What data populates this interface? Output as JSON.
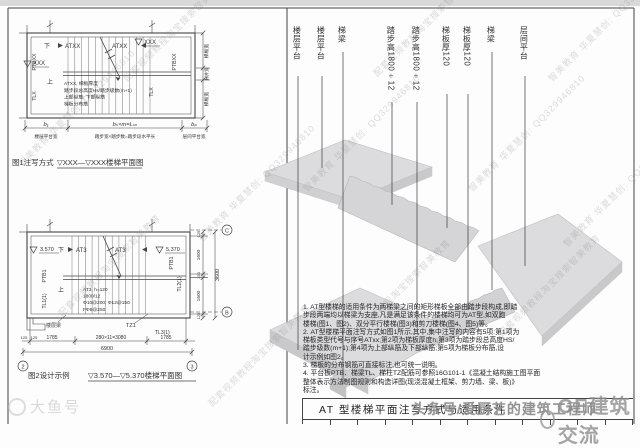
{
  "diagram1": {
    "caption_label": "图1注写方式",
    "caption_title": "▽XXX—▽XXX楼梯平面图",
    "labels": {
      "down": "下",
      "up": "上",
      "flight_left": "ATXX",
      "flight_right": "ATXX",
      "elev_left": "XXX",
      "elev_top_right": "XXX",
      "ptb_left": "PTBXX",
      "ptb_right": "PTBXX",
      "tl_left": "TLX",
      "tl_right": "TLX"
    },
    "note_block": {
      "l1": "ATXX, 梯板厚度",
      "l2": "踏步段总高度Hs/踏步级数(m+1)",
      "l3": "上部纵筋; 下部纵筋",
      "l4": "梯板分布筋"
    },
    "dims_bottom": {
      "seg1": "b₁",
      "seg2": "bₛ×m=Lₛₙ",
      "seg3": "bₚ",
      "sub1": "楼层平台宽",
      "sub2": "踏步宽×踏步数=踏步段水平长",
      "sub3": "层间平台宽"
    },
    "dims_right": {
      "r1": "梯板宽",
      "r2": "梯井宽",
      "r3": "梯板宽"
    }
  },
  "diagram2": {
    "caption_label": "图2设计示例",
    "caption_title": "▽3.570—▽5.370楼梯平面图",
    "labels": {
      "down": "下",
      "up": "上",
      "flight_left": "AT3",
      "flight_right": "AT3",
      "elev_left": "3.570",
      "elev_right": "5.370",
      "ptb_left": "PTB1",
      "ptb_right": "PTB1",
      "tl_left": "TL1(1)",
      "tl_right": "TL2(1)",
      "floor_beam": "楼层梁",
      "tz": "TZ1",
      "tl3": "TL3(1)"
    },
    "note_block": {
      "l1": "AT3, h=120",
      "l2": "1800/12",
      "l3": "Φ10@200; Φ12@150",
      "l4": "FΦ8@250"
    },
    "dims_bottom": {
      "off_l1": "125",
      "off_l2": "125",
      "seg1": "1785",
      "seg2": "280×11=3080",
      "seg3": "1785",
      "total": "6900",
      "axis_left": "2",
      "axis_right": "3"
    },
    "dims_right": {
      "v1": "125",
      "v2": "1600",
      "v3": "150",
      "v4": "1600",
      "v5": "125",
      "total": "3600",
      "axis_top": "C",
      "axis_bottom": "B"
    }
  },
  "iso": {
    "labels": [
      "楼层平台",
      "楼层平台",
      "梯梁",
      "踏步高1800÷12",
      "踏步高1800÷12",
      "梯板厚120",
      "梯板厚120",
      "梯梁",
      "层间平台"
    ]
  },
  "notes": {
    "text": "1. AT型楼梯的适用条件为两梯梁之间的矩形梯板全部由踏步段构成,即踏\n步段两端均以梯梁为支座,凡是满足该条件的楼梯均可为AT型,如双跑\n楼梯(图1、图2)、双分平行楼梯(图3)和剪刀楼梯(图4、图5)等。\n2. AT型楼梯平面注写方式如图1所示,其中,集中注写的内容有5项:第1项为\n梯板类型代号与序号ATxx;第2项为梯板厚度h;第3项为踏步段总高度HS/\n踏步级数(m+1);第4项为上部纵筋及下部纵筋;第5项为梯板分布筋,设\n计示例如图2。\n3. 梯板的分布钢筋可直接标注,也可统一说明。\n4. 平台板PTB、梯梁TL、梯柱TZ配筋可参照16G101-1《混凝土结构施工图平面\n整体表示方法制图规则和构造详图(现浇混凝土框架、剪力墙、梁、板)》\n标注。"
  },
  "title_block": {
    "title": "AT 型楼梯平面注写方式与适用条件"
  },
  "watermarks": {
    "diag_a": "智美教育 华夏慧创: QQ329946810",
    "diag_b": "配套视频教程淘宝搜索智美教育",
    "bottom_left": "大鱼号",
    "bottom_right": "GE建筑交流",
    "overlay": "头条号/爱厨艺的建筑工程师"
  },
  "colors": {
    "line": "#444444",
    "slab": "#d7d7d9",
    "slab_dark": "#c7c7c9"
  }
}
